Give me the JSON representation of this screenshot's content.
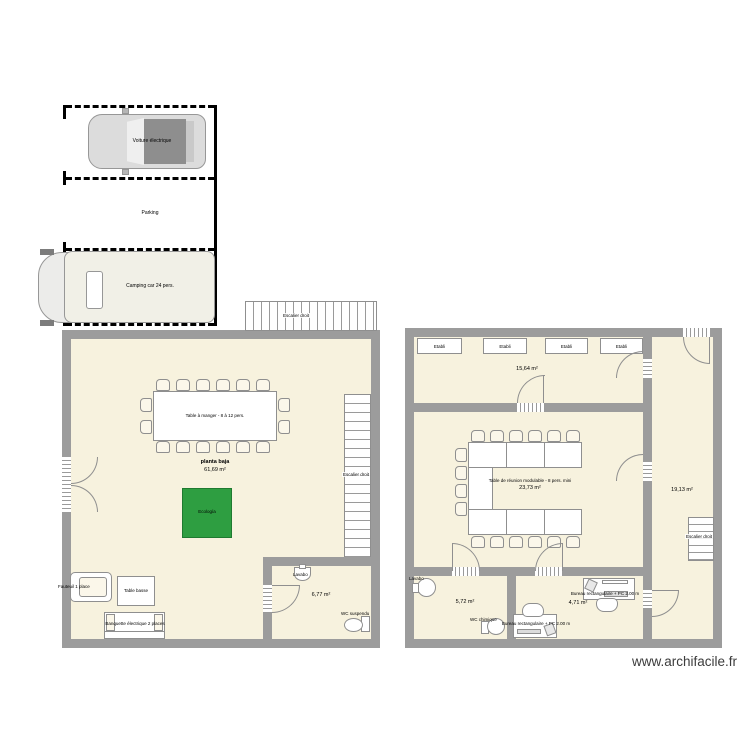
{
  "watermark": "www.archifacile.fr",
  "colors": {
    "wall": "#9c9c9c",
    "floor": "#f7f2de",
    "eco_green": "#2e9e41",
    "stroke": "#8f8f8f"
  },
  "parking": {
    "area_label": "Parking",
    "car_label": "Voiture électrique",
    "van_label": "Camping car 24 pers."
  },
  "main_building": {
    "floor_name": "planta baja",
    "floor_area": "61,69 m²",
    "dining_table": "Table à manger - 8 à 12 pers.",
    "eco_square": "Ecología",
    "stair_top": "Escalier droit",
    "stair_side": "Escalier droit",
    "armchair": "Fauteuil 1 place",
    "coffee_table": "Table basse",
    "bench": "Banquette électrique 2 places",
    "bathroom": {
      "area": "6,77 m²",
      "sink": "Lavabo",
      "toilet": "WC suspendu"
    }
  },
  "annex_building": {
    "workshop": {
      "area": "15,64 m²",
      "benches": [
        "Etabli",
        "Etabli",
        "Etabli",
        "Etabli"
      ]
    },
    "meeting_room": {
      "table": "Table de réunion modulable - 8 pers. mini",
      "area": "23,73 m²"
    },
    "corridor": {
      "area": "19,13 m²",
      "stair": "Escalier droit"
    },
    "washroom": {
      "area": "5,72 m²",
      "sink": "Lavabo"
    },
    "office": {
      "area": "4,71 m²",
      "desk_right": "Bureau rectangulaire + PC 2.00 m",
      "desk_bottom": "Bureau rectangulaire + PC 2.00 m",
      "toilet": "WC chimique"
    }
  }
}
